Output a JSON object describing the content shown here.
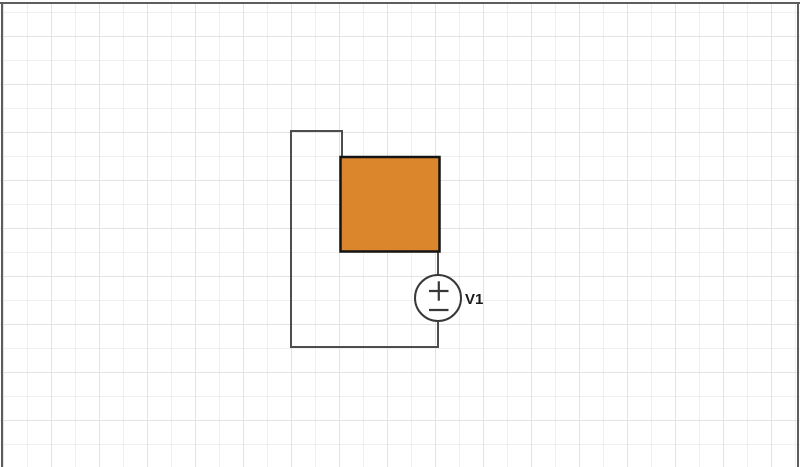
{
  "canvas": {
    "background_color": "#ffffff",
    "grid_major_color": "#e3e3e3",
    "grid_minor_color": "#efefef",
    "edge_color": "#5d5d5d"
  },
  "diagram": {
    "box": {
      "fill": "#db852c",
      "stroke": "#141414"
    },
    "source": {
      "label": "V1",
      "stroke": "#383838",
      "fill": "#ffffff",
      "label_color": "#1a1a1a",
      "polarity_top": "+",
      "polarity_bottom": "−"
    },
    "wire": {
      "color": "#4d4d4d"
    }
  }
}
